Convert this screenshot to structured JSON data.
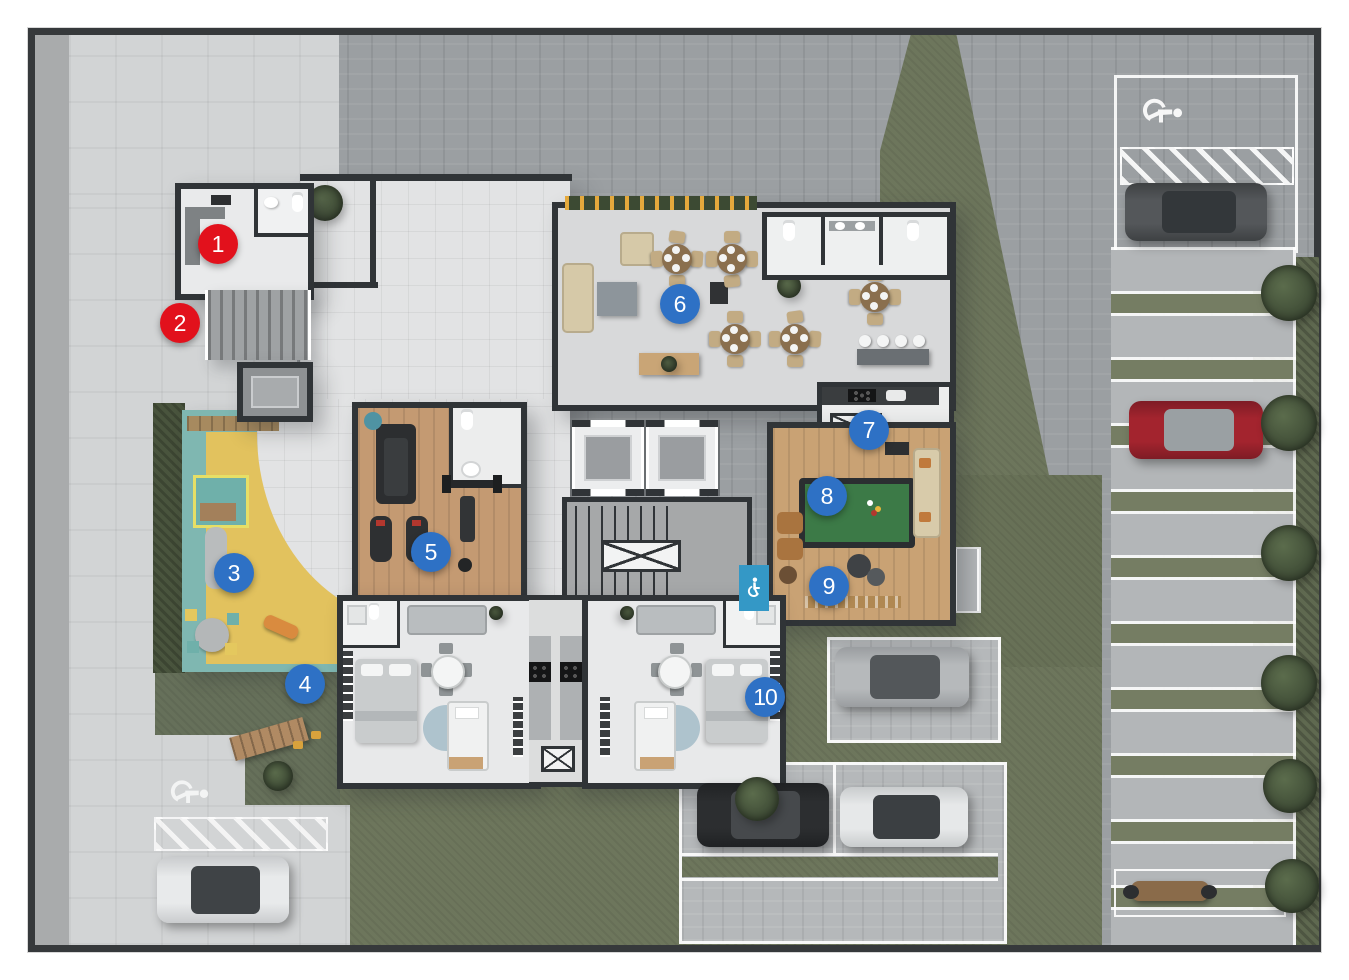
{
  "plan": {
    "type": "residential-ground-floor-site-plan",
    "markers": [
      {
        "number": "1",
        "color": "red"
      },
      {
        "number": "2",
        "color": "red"
      },
      {
        "number": "3",
        "color": "blue"
      },
      {
        "number": "4",
        "color": "blue"
      },
      {
        "number": "5",
        "color": "blue"
      },
      {
        "number": "6",
        "color": "blue"
      },
      {
        "number": "7",
        "color": "blue"
      },
      {
        "number": "8",
        "color": "blue"
      },
      {
        "number": "9",
        "color": "blue"
      },
      {
        "number": "10",
        "color": "blue"
      }
    ],
    "palette": {
      "marker_red": "#e2111c",
      "marker_blue": "#2e71c5",
      "accessibility_blue": "#3498c6",
      "crosswalk_yellow": "#e7c650",
      "playground_yellow": "#e2c25e",
      "playground_teal": "#7fb7b1",
      "pool_table_green": "#3c7a47",
      "lawn_green": "#6d765c",
      "paver_gray": "#9b9fa2",
      "concrete_light": "#d2d4d5",
      "wood_floor": "#c49a72",
      "wall_dark": "#303437"
    },
    "icons": {
      "accessibility": "wheelchair-icon"
    }
  }
}
